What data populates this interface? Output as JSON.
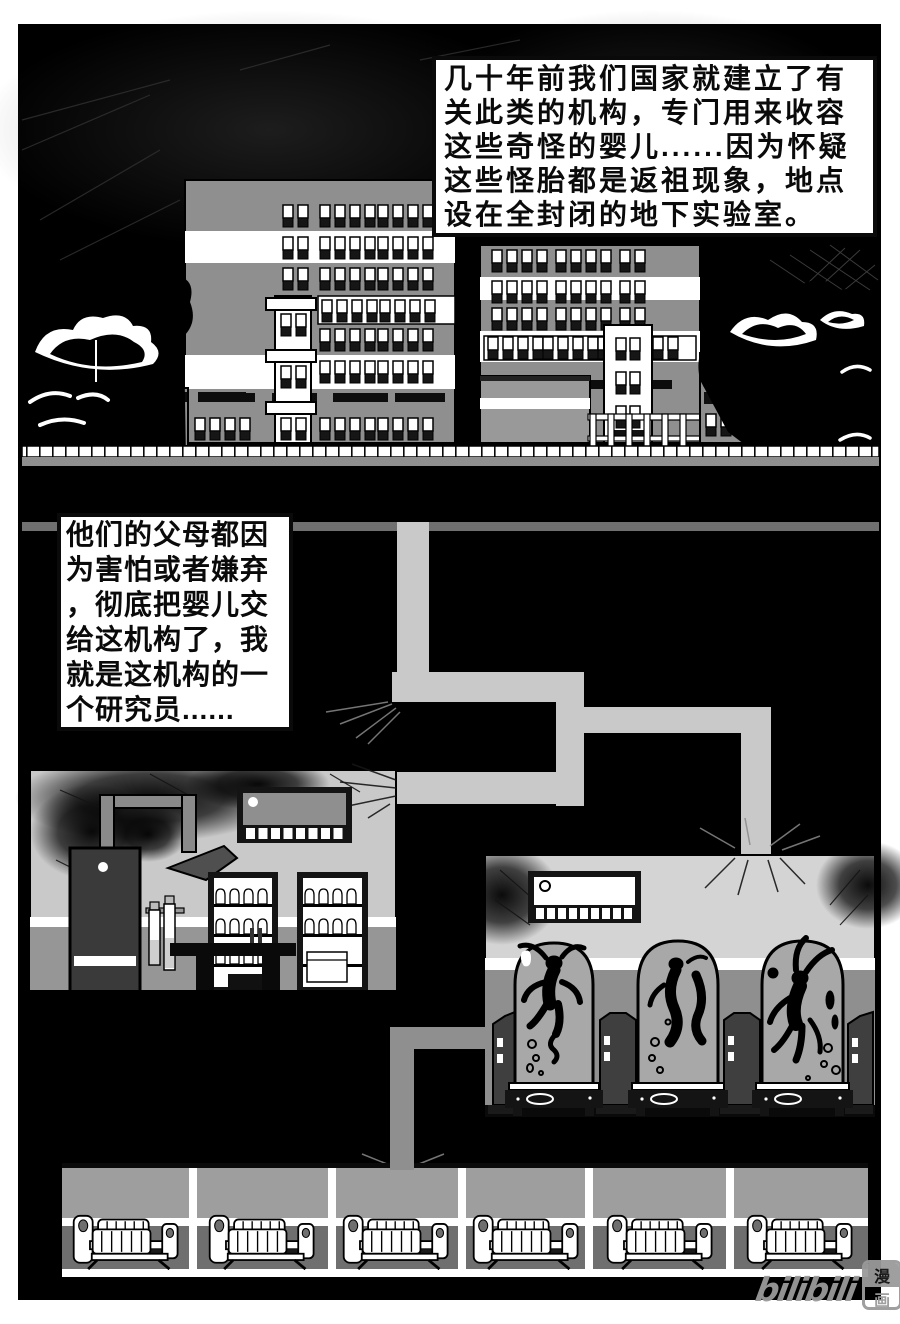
{
  "page": {
    "kind": "manga-page",
    "panels": "single full-bleed night/underground cross-section"
  },
  "captions": {
    "narration_1": {
      "lines": [
        "几十年前我们国家就建立了有",
        "关此类的机构，专门用来收容",
        "这些奇怪的婴儿......因为怀疑",
        "这些怪胎都是返祖现象，地点",
        "设在全封闭的地下实验室。"
      ]
    },
    "narration_2": {
      "lines": [
        "他们的父母都因",
        "为害怕或者嫌弃",
        "，彻底把婴儿交",
        "给这机构了，我",
        "就是这机构的一",
        "个研究员......"
      ]
    }
  },
  "watermark": {
    "brand": "bilibili",
    "char_top": "漫",
    "char_bottom": "画"
  },
  "palette": {
    "paper": "#ffffff",
    "ink": "#0a0a0a",
    "facade": "#8f8f8f",
    "window_dark": "#161616",
    "corridor": "#c9c9c9",
    "sub_corridor": "#8f8f8f",
    "room_wall_upper": "#cccccc",
    "room_wall_lower": "#919191",
    "tank_glass": "#a8a8a8",
    "dorm_wall_upper": "#9e9e9e",
    "dorm_wall_lower": "#6f6f6f",
    "watermark_gray": "#9a9a9a"
  },
  "scene_elements": [
    "night-sky",
    "apartment-building-left",
    "apartment-building-right",
    "trees",
    "street-wall",
    "underground-staircase-corridor",
    "lab-room-with-shelves",
    "wall-monitor",
    "specimen-tanks-with-creatures",
    "dormitory-hall-with-cribs"
  ]
}
